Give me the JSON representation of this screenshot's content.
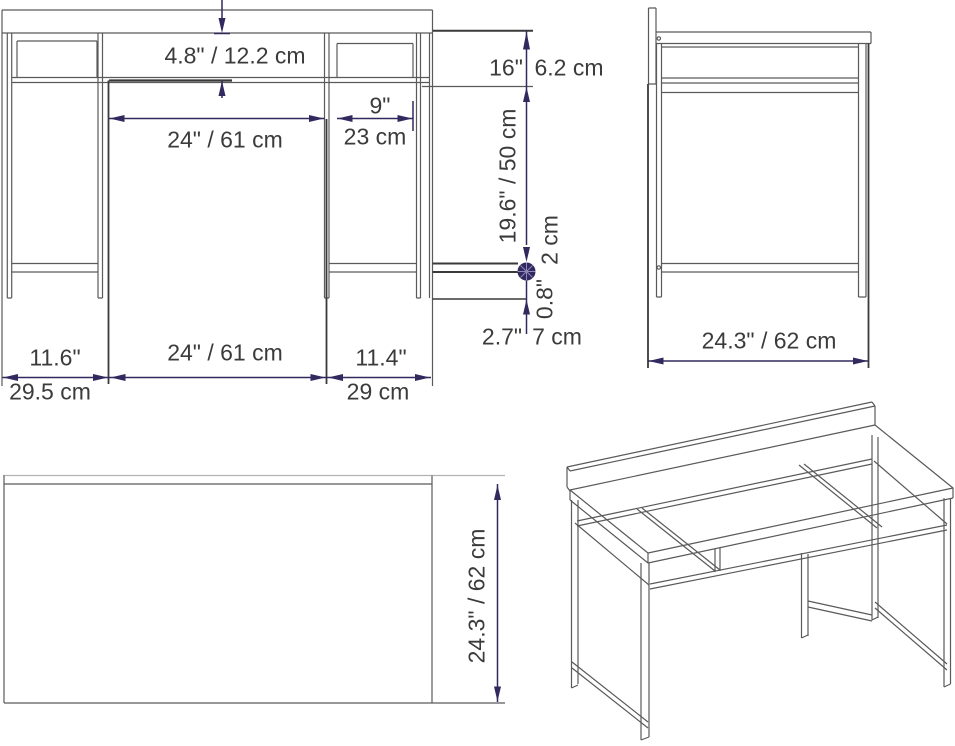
{
  "colors": {
    "dimension_accent": "#32295E",
    "structure_line": "#5a5a5a",
    "label_text": "#3b3b3b"
  },
  "front_view": {
    "shelf_height": "4.8\" / 12.2 cm",
    "center_opening_width": "24\" / 61 cm",
    "right_opening_width_in": "9\"",
    "right_opening_width_cm": "23 cm",
    "top_shelf_height_in": "16\"",
    "top_shelf_height_cm": "6.2 cm",
    "leg_clearance": "19.6\" / 50 cm",
    "stretcher_thickness_cm": "2 cm",
    "stretcher_thickness_in": "0.8\"",
    "foot_height_in": "2.7\"",
    "foot_height_cm": "7 cm",
    "left_section_in": "11.6\"",
    "left_section_cm": "29.5 cm",
    "center_section": "24\" / 61 cm",
    "right_section_in": "11.4\"",
    "right_section_cm": "29 cm"
  },
  "side_view": {
    "depth": "24.3\" / 62 cm"
  },
  "top_view": {
    "depth": "24.3\" / 62 cm"
  }
}
